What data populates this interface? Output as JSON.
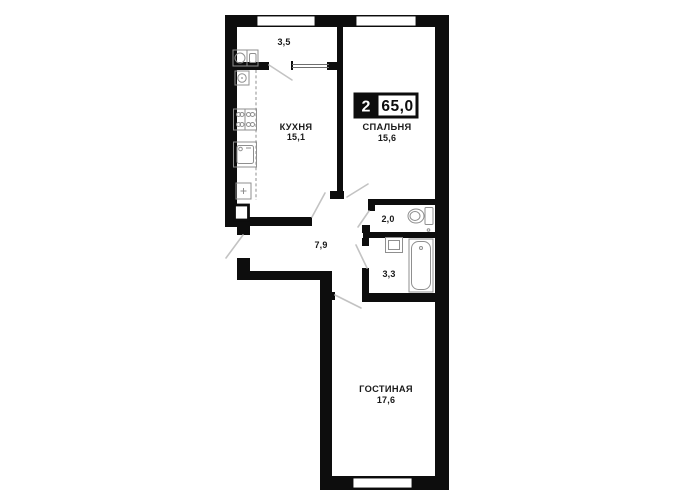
{
  "colors": {
    "wall": "#0d0d0d",
    "fixture": "#8f8f8f",
    "door": "#c3c3c3",
    "bg": "#ffffff",
    "text": "#1a1a1a"
  },
  "badge": {
    "rooms_count": "2",
    "total_area": "65,0"
  },
  "rooms": {
    "balcony": {
      "area": "3,5"
    },
    "kitchen": {
      "name": "КУХНЯ",
      "area": "15,1"
    },
    "bedroom": {
      "name": "СПАЛЬНЯ",
      "area": "15,6"
    },
    "wc": {
      "area": "2,0"
    },
    "bathroom": {
      "area": "3,3"
    },
    "hallway": {
      "area": "7,9"
    },
    "living_room": {
      "name": "ГОСТИНАЯ",
      "area": "17,6"
    }
  }
}
